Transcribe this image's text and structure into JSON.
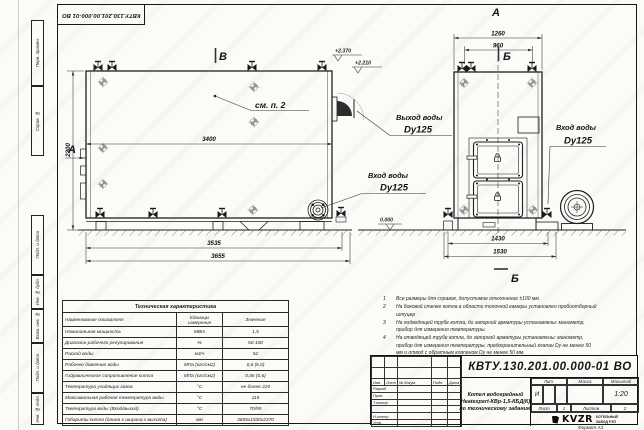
{
  "sheet": {
    "doc_number_top": "КВТУ.130.201.00.000-01 ВО",
    "format_label": "Формат А3"
  },
  "stamp_column": {
    "boxes": [
      "Перв. примен.",
      "Справ. №",
      "Подп. и дата",
      "Инв. № дубл.",
      "Взам. инв. №",
      "Подп. и дата",
      "Инв. № подл."
    ]
  },
  "side_view": {
    "section_mark": "В",
    "view_arrow_label": "А",
    "callout": "см. п. 2",
    "dim_width": "3400",
    "dim_height": "2300",
    "elev_1": "+2.370",
    "elev_2": "+2.210",
    "elev_zero": "0.000",
    "outlet_title": "Выход воды",
    "outlet_size": "Dy125",
    "inlet_title": "Вход воды",
    "inlet_size": "Dy125",
    "dim_base": "3535",
    "dim_total": "3655"
  },
  "front_view": {
    "view_label": "А",
    "section_mark": "Б",
    "dim_overall": "1260",
    "dim_inner": "960",
    "inlet_title": "Вход воды",
    "inlet_size": "Dy125",
    "dim_base": "1430",
    "dim_total": "1530"
  },
  "notes": {
    "items": [
      {
        "num": "1",
        "text": "Все размеры для справок, допустимое отклонение ±100 мм."
      },
      {
        "num": "2",
        "text": "На боковой стенке котла в области топочной камеры установлен пробоотборный штуцер"
      },
      {
        "num": "3",
        "text": "На подводящей трубе котла, до запорной арматуры установлены: манометр, прибор для измерения температуры."
      },
      {
        "num": "4",
        "text": "На отводящей трубе котла, до запорной арматуры установлены: манометр, прибор для измерения температуры, предохранительный клапан Dу не менее 50 мм и отвод с обратным клапаном Dу не менее 50 мм."
      }
    ]
  },
  "tech_table": {
    "title": "Техническая характеристика",
    "headers": [
      "Наименование показателя",
      "Единицы измерения",
      "Значение"
    ],
    "rows": [
      [
        "Номинальная мощность",
        "МВт",
        "1,5"
      ],
      [
        "Диапазон рабочего регулирования",
        "%",
        "50-100"
      ],
      [
        "Расход воды",
        "м3/ч",
        "52"
      ],
      [
        "Рабочее давление воды",
        "МПа (кгс/см2)",
        "0,6 (6,0)"
      ],
      [
        "Гидравлическое сопротивление котла",
        "МПа (кгс/см2)",
        "0,06 (0,6)"
      ],
      [
        "Температура уходящих газов",
        "°С",
        "не более 220"
      ],
      [
        "Максимальная рабочая температура воды",
        "°С",
        "115"
      ],
      [
        "Температура воды (Вход/выход)",
        "°С",
        "70/95"
      ],
      [
        "Габариты котла (длина х ширина х высота)",
        "мм",
        "3655х1530х2370"
      ]
    ]
  },
  "title_block": {
    "doc_number": "КВТУ.130.201.00.000-01 ВО",
    "product_line1": "Котел водогрейный",
    "product_line2": "Heatexpert-КВр-1,5-КБД(К)",
    "product_line3": "по техническому заданию",
    "cols": {
      "izm": "Изм",
      "list": "Лист",
      "doc": "№ докум.",
      "podp": "Подп.",
      "data": "Дата"
    },
    "rows": [
      "Разраб.",
      "Пров.",
      "Т.контр.",
      "Н.контр.",
      "Утв."
    ],
    "lit_header": "Лит.",
    "mass_header": "Масса",
    "scale_header": "Масштаб",
    "lit_value": "И",
    "scale_value": "1:20",
    "sheet_label": "Лист",
    "sheet_num": "1",
    "sheets_label": "Листов",
    "sheets_num": "2",
    "logo_text": "KVZR",
    "logo_caption1": "КОТЕЛЬНЫЙ",
    "logo_caption2": "ЗАВОД РЭП"
  }
}
